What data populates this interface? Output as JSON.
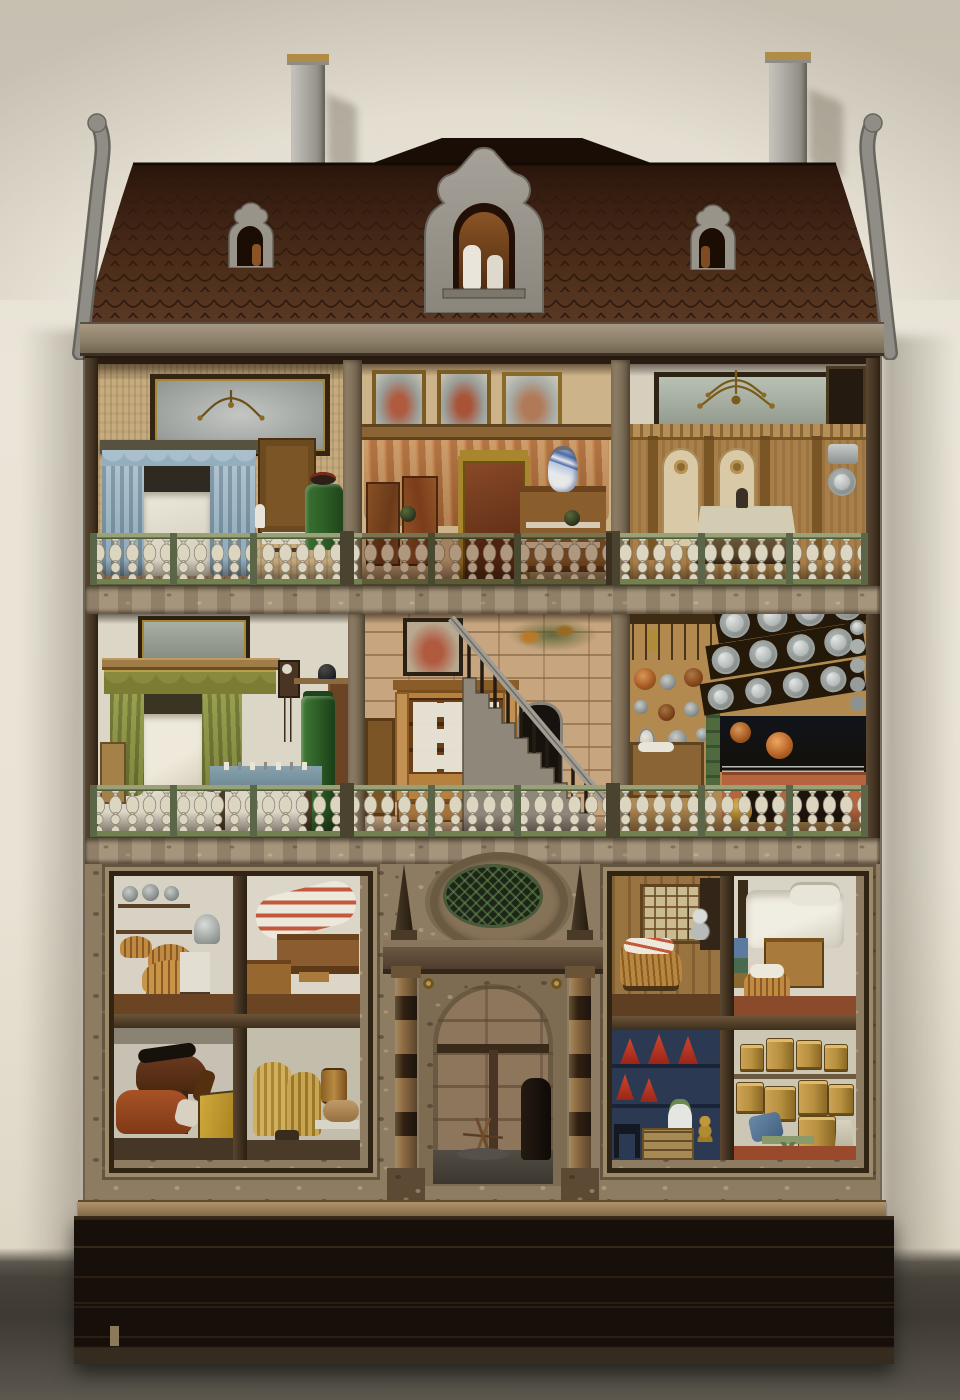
{
  "scene": {
    "type": "photograph",
    "subject": "Baroque cabinet dollhouse with open front showing three furnished storeys, shingled mansard roof with scrolled dormers and two chimneys, standing on a dark wooden plinth against a pale wall",
    "setting": "pale plaster wall behind, dark grey carpet floor below"
  },
  "palette": {
    "wall": "#e8e3d6",
    "carpet": "#45423b",
    "roof_dark": "#301a0e",
    "roof_light": "#573726",
    "shingle_line": "#1d0e06",
    "dormer_grey": "#98948a",
    "chimney_grey": "#b0aea6",
    "chimney_cap_gold": "#b08c47",
    "cornice": "#948771",
    "beam": "#a5957c",
    "baluster_ivory": "#dcd5c0",
    "rail_green": "#71814f",
    "wood_dark": "#4a3826",
    "wood_mid": "#8a5e2c",
    "wood_light": "#b5813c",
    "stove_green": "#2f6128",
    "curtain_blue": "#a9bfcc",
    "curtain_olive": "#8f9448",
    "drape_apricot": "#c08a58",
    "kitchen_ochre": "#b28a50",
    "pewter": "#b4bab8",
    "copper": "#a85c24",
    "hearth_terracotta": "#b5643e",
    "stone_block": "#c7a57f",
    "frame_mottle": "#8d7b62",
    "plinth": "#170f0a",
    "blue_room": "#2b3a52",
    "cone_red": "#b03020",
    "straw": "#c8a455",
    "horse_brown": "#5a3018",
    "cow_russet": "#9a4a22",
    "trough_yellow": "#c29a33",
    "floor_redbrown": "#8a4a2c"
  },
  "structure": {
    "roof": {
      "label": "shingled-mansard-roof",
      "chimney_count": 2,
      "dormers": [
        "small-scroll-dormer-left",
        "baroque-center-dormer",
        "small-scroll-dormer-right"
      ],
      "gables": [
        "scroll-gable-board-left",
        "scroll-gable-board-right"
      ]
    },
    "floors": [
      {
        "label": "upper floor",
        "rooms": [
          {
            "name": "bedchamber-with-blue-canopy-bed",
            "items": [
              "overmantel-painting",
              "brass-chandelier",
              "blue-silk-canopy-bed",
              "walnut-cabinet",
              "green-tile-stove",
              "covered-table"
            ]
          },
          {
            "name": "draped-state-room",
            "items": [
              "three-saint-portraits",
              "paisley-wall-drapery",
              "gilt-framed-pier-glass",
              "marbled-panels",
              "sideboard-with-dishes",
              "blue-white-faience-jug"
            ]
          },
          {
            "name": "panelled-dining-hall",
            "items": [
              "landscape-painting",
              "brass-chandelier",
              "oak-wainscot-with-pilasters",
              "cloth-covered-table",
              "pewter-wall-fountain"
            ]
          }
        ]
      },
      {
        "label": "middle floor",
        "rooms": [
          {
            "name": "bedchamber-with-green-canopy-bed",
            "items": [
              "landscape-painting",
              "green-canopy-bed",
              "hanging-wall-clock",
              "green-tile-stove",
              "table-with-blue-cloth",
              "wardrobe"
            ]
          },
          {
            "name": "stair-hall",
            "items": [
              "ashlar-painted-walls",
              "staircase-with-turned-balusters",
              "linen-cupboard-with-folded-linen",
              "arched-mirror",
              "painted-garland"
            ]
          },
          {
            "name": "kitchen",
            "items": [
              "hanging-copper-pans",
              "utensil-rail",
              "pewter-plate-rack",
              "open-hearth",
              "terracotta-stove-base",
              "wooden-dresser"
            ]
          }
        ]
      },
      {
        "label": "ground floor",
        "rooms": [
          {
            "name": "pantry-with-baskets"
          },
          {
            "name": "servants-chamber"
          },
          {
            "name": "stable-with-horse-and-cow"
          },
          {
            "name": "straw-store"
          },
          {
            "name": "stone-entrance-hall"
          },
          {
            "name": "nursery-with-cradle"
          },
          {
            "name": "bedchamber-with-white-bed"
          },
          {
            "name": "blue-store-room"
          },
          {
            "name": "cooperage-store"
          }
        ]
      }
    ],
    "portal": {
      "name": "baroque-stone-portal",
      "items": [
        "wreathed-cartouche",
        "obelisk-finials",
        "marbled-columns",
        "round-arch"
      ]
    },
    "base": {
      "name": "dark-wooden-plinth"
    },
    "balustrades": {
      "label": "turned-ivory-balusters-with-green-rails",
      "count": 2
    }
  }
}
